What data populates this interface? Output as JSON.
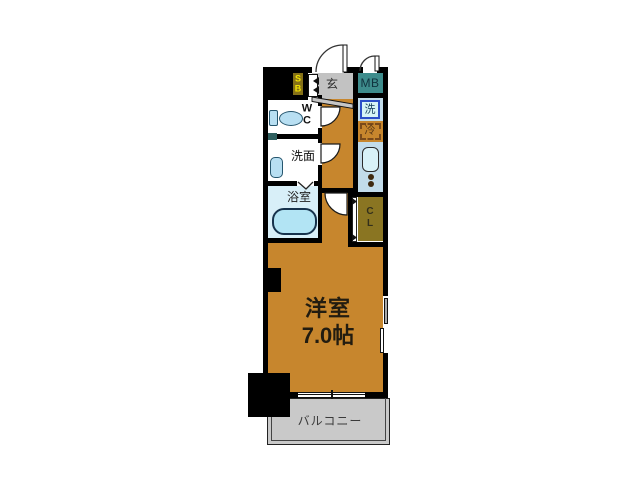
{
  "plan": {
    "main_room": {
      "name": "洋室",
      "size": "7.0帖"
    },
    "balcony_label": "バルコニー",
    "entrance_label": "玄",
    "meter_box_label": "MB",
    "shoe_box": {
      "line1": "S",
      "line2": "B"
    },
    "washer_label": "洗",
    "fridge_label": "冷",
    "toilet": {
      "line1": "W",
      "line2": "C"
    },
    "washroom_label": "洗面",
    "bathroom_label": "浴室",
    "closet": {
      "line1": "C",
      "line2": "L"
    },
    "colors": {
      "room_orange": "#C7862D",
      "entrance_gray": "#C2C2C2",
      "balcony_gray": "#C9C9C9",
      "meter_box_teal": "#3E8C8C",
      "shoe_box_olive": "#857117",
      "closet_olive": "#8A7522",
      "water_area_blue": "#C2DCEA",
      "fixture_blue": "#B8DFF2",
      "bathroom_blue": "#D8EFF8",
      "washer_border_blue": "#2B4FC8",
      "fridge_dash_brown": "#7A4A1A",
      "sb_text_yellow": "#F2E300",
      "wall_black": "#000000"
    }
  }
}
